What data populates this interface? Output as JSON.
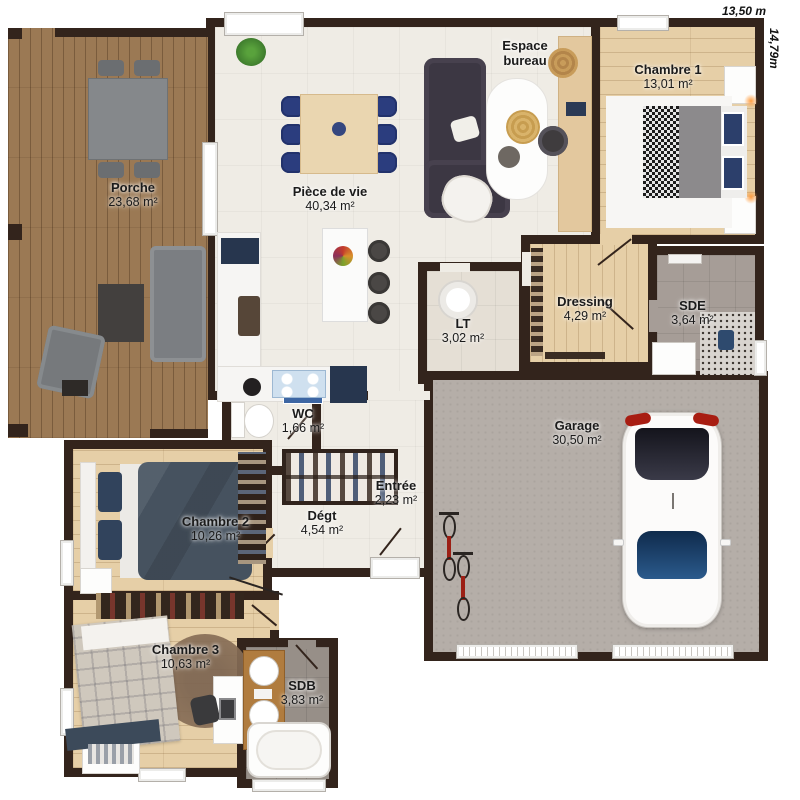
{
  "dims": {
    "width": "13,50 m",
    "height": "14,79m"
  },
  "rooms": {
    "porche": {
      "name": "Porche",
      "area": "23,68 m²"
    },
    "piece_de_vie": {
      "name": "Pièce de vie",
      "area": "40,34 m²"
    },
    "espace_bureau": {
      "name": "Espace bureau",
      "area": ""
    },
    "chambre1": {
      "name": "Chambre 1",
      "area": "13,01 m²"
    },
    "dressing": {
      "name": "Dressing",
      "area": "4,29 m²"
    },
    "sde": {
      "name": "SDE",
      "area": "3,64 m²"
    },
    "lt": {
      "name": "LT",
      "area": "3,02 m²"
    },
    "wc": {
      "name": "WC",
      "area": "1,66 m²"
    },
    "garage": {
      "name": "Garage",
      "area": "30,50 m²"
    },
    "entree": {
      "name": "Entrée",
      "area": "2,23 m²"
    },
    "degt": {
      "name": "Dégt",
      "area": "4,54 m²"
    },
    "chambre2": {
      "name": "Chambre 2",
      "area": "10,26 m²"
    },
    "chambre3": {
      "name": "Chambre 3",
      "area": "10,63 m²"
    },
    "sdb": {
      "name": "SDB",
      "area": "3,83 m²"
    }
  },
  "colors": {
    "wall": "#33241c",
    "floor_cream": "#efece5",
    "wood_light": "#e6cfa7",
    "deck_wood": "#9b7954",
    "concrete": "#b5aea8",
    "tile_gray": "#a69d97",
    "accent_navy": "#2b3d7e",
    "car_red": "#a81d12"
  }
}
